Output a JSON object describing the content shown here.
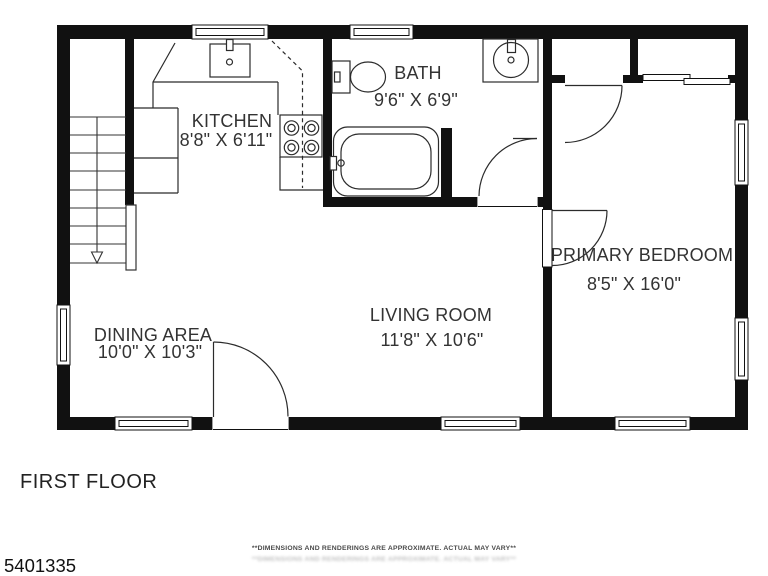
{
  "plan": {
    "wall_color": "#111111",
    "line_color": "#2b2b2b",
    "rooms": {
      "kitchen": {
        "name": "KITCHEN",
        "dims": "8'8\" X 6'11\""
      },
      "bath": {
        "name": "BATH",
        "dims": "9'6\" X 6'9\""
      },
      "dining": {
        "name": "DINING AREA",
        "dims": "10'0\" X 10'3\""
      },
      "living": {
        "name": "LIVING ROOM",
        "dims": "11'8\" X 10'6\""
      },
      "bedroom": {
        "name": "PRIMARY BEDROOM",
        "dims": "8'5\" X 16'0\""
      }
    },
    "fixtures": [
      "stairs-with-down-arrow",
      "kitchen-sink",
      "stove-4-burner",
      "toilet",
      "bathroom-round-sink",
      "bathtub",
      "closet-hinged-door",
      "closet-sliding-doors"
    ]
  },
  "footer": {
    "plan_label": "FIRST FLOOR",
    "listing_id": "5401335",
    "disclaimer": "**DIMENSIONS AND RENDERINGS ARE APPROXIMATE. ACTUAL MAY VARY**"
  }
}
